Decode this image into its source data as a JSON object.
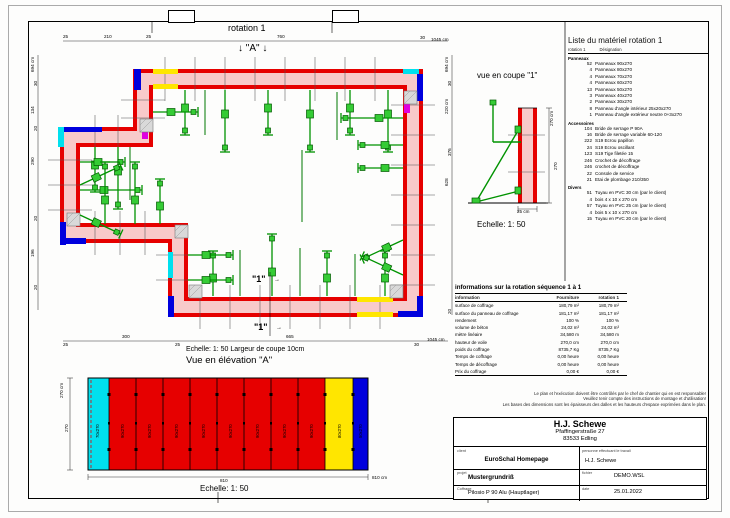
{
  "page": {
    "rotation_title": "rotation 1",
    "marker_a": "↓ \"A\" ↓",
    "marker_1": "\"1\"",
    "arrow_right": "→"
  },
  "plan": {
    "scale_note": "Echelle: 1: 50   Largeur de coupe 10cm",
    "dims_top": [
      "25",
      "210",
      "25",
      "760",
      "30",
      "1045 cm"
    ],
    "dims_bottom": [
      "25",
      "300",
      "25",
      "665",
      "30",
      "1045 cm"
    ],
    "dims_left": [
      "694 cm",
      "30",
      "134",
      "20",
      "290",
      "20",
      "196",
      "20"
    ],
    "dims_right": [
      "694 cm",
      "30",
      "220 cm",
      "376",
      "628",
      "20"
    ]
  },
  "coupe": {
    "title": "vue en coupe \"1\"",
    "scale": "Echelle: 1: 50",
    "dim_total": "270 cm",
    "dim_segment": "270",
    "dim_width": "25 cm"
  },
  "elevation": {
    "title": "Vue en élévation \"A\"",
    "scale": "Echelle: 1: 50",
    "dim_total": "270 cm",
    "dim_segment": "270",
    "dim_width": "810",
    "dim_width_total": "810 cm",
    "panels": [
      {
        "label": "70x270",
        "color": "#00e0ee"
      },
      {
        "label": "90x270",
        "color": "#e60000"
      },
      {
        "label": "90x270",
        "color": "#e60000"
      },
      {
        "label": "90x270",
        "color": "#e60000"
      },
      {
        "label": "90x270",
        "color": "#e60000"
      },
      {
        "label": "90x270",
        "color": "#e60000"
      },
      {
        "label": "90x270",
        "color": "#e60000"
      },
      {
        "label": "90x270",
        "color": "#e60000"
      },
      {
        "label": "90x270",
        "color": "#e60000"
      },
      {
        "label": "80x270",
        "color": "#ffe600"
      },
      {
        "label": "50x270",
        "color": "#0000dd"
      }
    ]
  },
  "material_list": {
    "title": "Liste du matériel  rotation 1",
    "col_rotation": "rotation 1",
    "col_designation": "Désignation",
    "sections": [
      {
        "name": "Panneaux",
        "items": [
          {
            "qty": "52",
            "name": "Panneaux 90x270"
          },
          {
            "qty": "4",
            "name": "Panneaux 80x270"
          },
          {
            "qty": "4",
            "name": "Panneaux 70x270"
          },
          {
            "qty": "4",
            "name": "Panneaux 60x270"
          },
          {
            "qty": "13",
            "name": "Panneaux 50x270"
          },
          {
            "qty": "3",
            "name": "Panneaux 40x270"
          },
          {
            "qty": "2",
            "name": "Panneaux 30x270"
          },
          {
            "qty": "8",
            "name": "Panneau d'angle intérieur 25x20x270"
          },
          {
            "qty": "1",
            "name": "Panneau d'angle extérieur neutre 0+3x270"
          }
        ]
      },
      {
        "name": "Accessoires",
        "items": [
          {
            "qty": "104",
            "name": "Bride de serrage P 90A"
          },
          {
            "qty": "16",
            "name": "Bride de serrage variable 60-120"
          },
          {
            "qty": "222",
            "name": "S19 Ecrou papillon"
          },
          {
            "qty": "24",
            "name": "S19 Ecrou oscillant"
          },
          {
            "qty": "123",
            "name": "S19 Tige filetée 15"
          },
          {
            "qty": "246",
            "name": "Crochet de décoffrage"
          },
          {
            "qty": "246",
            "name": "crochet de décoffrage"
          },
          {
            "qty": "22",
            "name": "Console de service"
          },
          {
            "qty": "21",
            "name": "Etai de plombage 210/350"
          }
        ]
      },
      {
        "name": "Divers",
        "items": [
          {
            "qty": "51",
            "name": "Tuyau en PVC 30 cm (par le client)"
          },
          {
            "qty": "4",
            "name": "bois 4 x 10 x 270 cm"
          },
          {
            "qty": "57",
            "name": "Tuyau en PVC 25 cm (par le client)"
          },
          {
            "qty": "4",
            "name": "bois 5 x 10 x 270 cm"
          },
          {
            "qty": "15",
            "name": "Tuyau en PVC 20 cm (par le client)"
          }
        ]
      }
    ]
  },
  "info_table": {
    "title": "informations sur la rotation  séquence 1 à 1",
    "columns": [
      "information",
      "Fourniture",
      "rotation 1"
    ],
    "rows": [
      [
        "surface de coffrage",
        "180,79 m²",
        "180,79 m²"
      ],
      [
        "surface du panneau de coffrage",
        "181,17 m²",
        "181,17 m²"
      ],
      [
        "rendement",
        "100 %",
        "100 %"
      ],
      [
        "volume de béton",
        "24,02 m³",
        "24,02 m³"
      ],
      [
        "mètre linéaire",
        "34,580 m",
        "34,580 m"
      ],
      [
        "hauteur de voile",
        "270,0 cm",
        "270,0 cm"
      ],
      [
        "poids du coffrage",
        "8735,7 Kg",
        "8735,7 Kg"
      ],
      [
        "Temps de coffrage",
        "0,00 heure",
        "0,00 heure"
      ],
      [
        "Temps de décoffrage",
        "0,00 heure",
        "0,00 heure"
      ],
      [
        "Prix du coffrage",
        "0,00 €",
        "0,00 €"
      ]
    ]
  },
  "title_block": {
    "disclaimer_line1": "Le plan et l'exécution doivent être contrôlés par le chef de chantier qui en est responsable!",
    "disclaimer_line2": "Veuillez tenir compte des instructions de montage et d'utilisation!",
    "disclaimer_line3": "Les bases des dimensions sont les épaisseurs des dalles et les hauteurs d'espace exprimées dans le plan.",
    "company": "H.J. Schewe",
    "address1": "Pfaffingerstraße 27",
    "address2": "83533 Edling",
    "client_label": "client",
    "client": "EuroSchal Homepage",
    "worker_label": "personne effectuant le travail",
    "worker": "H.J. Schewe",
    "project_label": "projet",
    "project": "Mustergrundriß",
    "file_label": "fichier",
    "file": "DEMO.WSL",
    "formwork_label": "Coffrage",
    "formwork": "Pilosio P 90 Alu (Hauptlager)",
    "date_label": "date",
    "date": "25.01.2022"
  },
  "colors": {
    "panel_red": "#e60000",
    "wall_fill": "#f8caca",
    "accent_blue": "#0000dd",
    "accent_cyan": "#00e0ee",
    "accent_yellow": "#ffe600",
    "accent_magenta": "#e000e0",
    "prop_green": "#35cc35"
  }
}
